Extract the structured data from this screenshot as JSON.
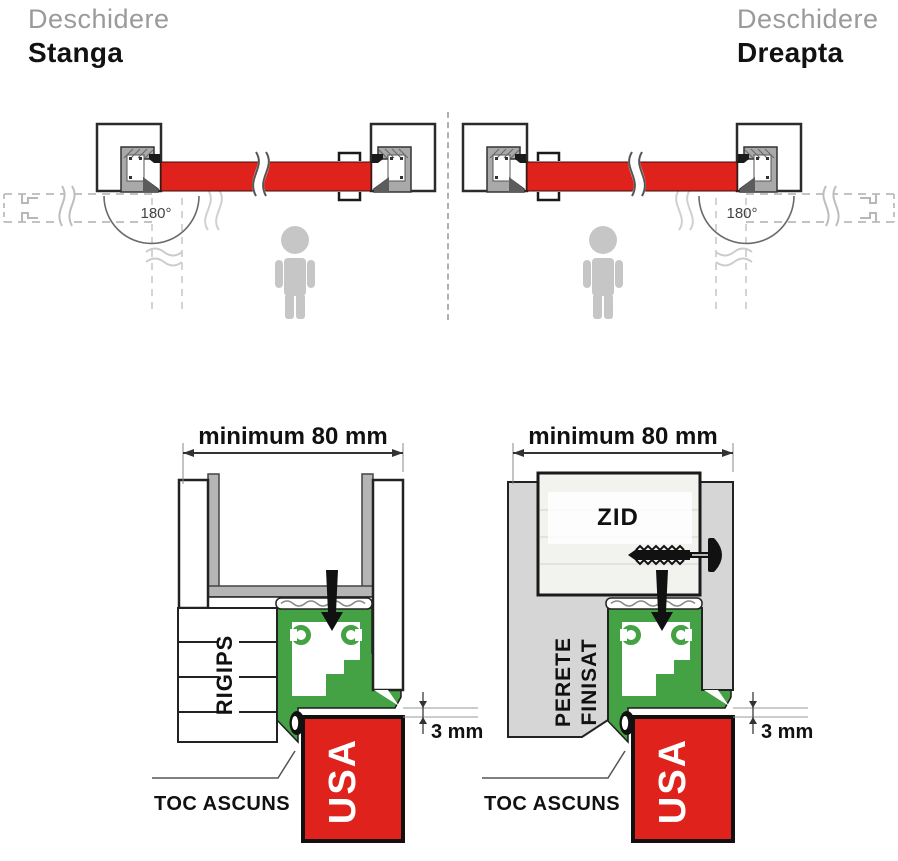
{
  "header": {
    "left": {
      "subtitle": "Deschidere",
      "title": "Stanga"
    },
    "right": {
      "subtitle": "Deschidere",
      "title": "Dreapta"
    }
  },
  "plan": {
    "angle_label": "180°"
  },
  "section": {
    "dimension_label": "minimum 80 mm",
    "gap_label": "3 mm",
    "frame_label": "TOC ASCUNS",
    "door_label": "USA",
    "left": {
      "wall_label": "RIGIPS"
    },
    "right": {
      "wall_label_line1": "PERETE",
      "wall_label_line2": "FINISAT",
      "core_label": "ZID"
    }
  },
  "colors": {
    "door_red": "#e0221c",
    "frame_green": "#44a244",
    "wall_gray": "#d6d6d6",
    "figure_gray": "#c6c6c6"
  }
}
